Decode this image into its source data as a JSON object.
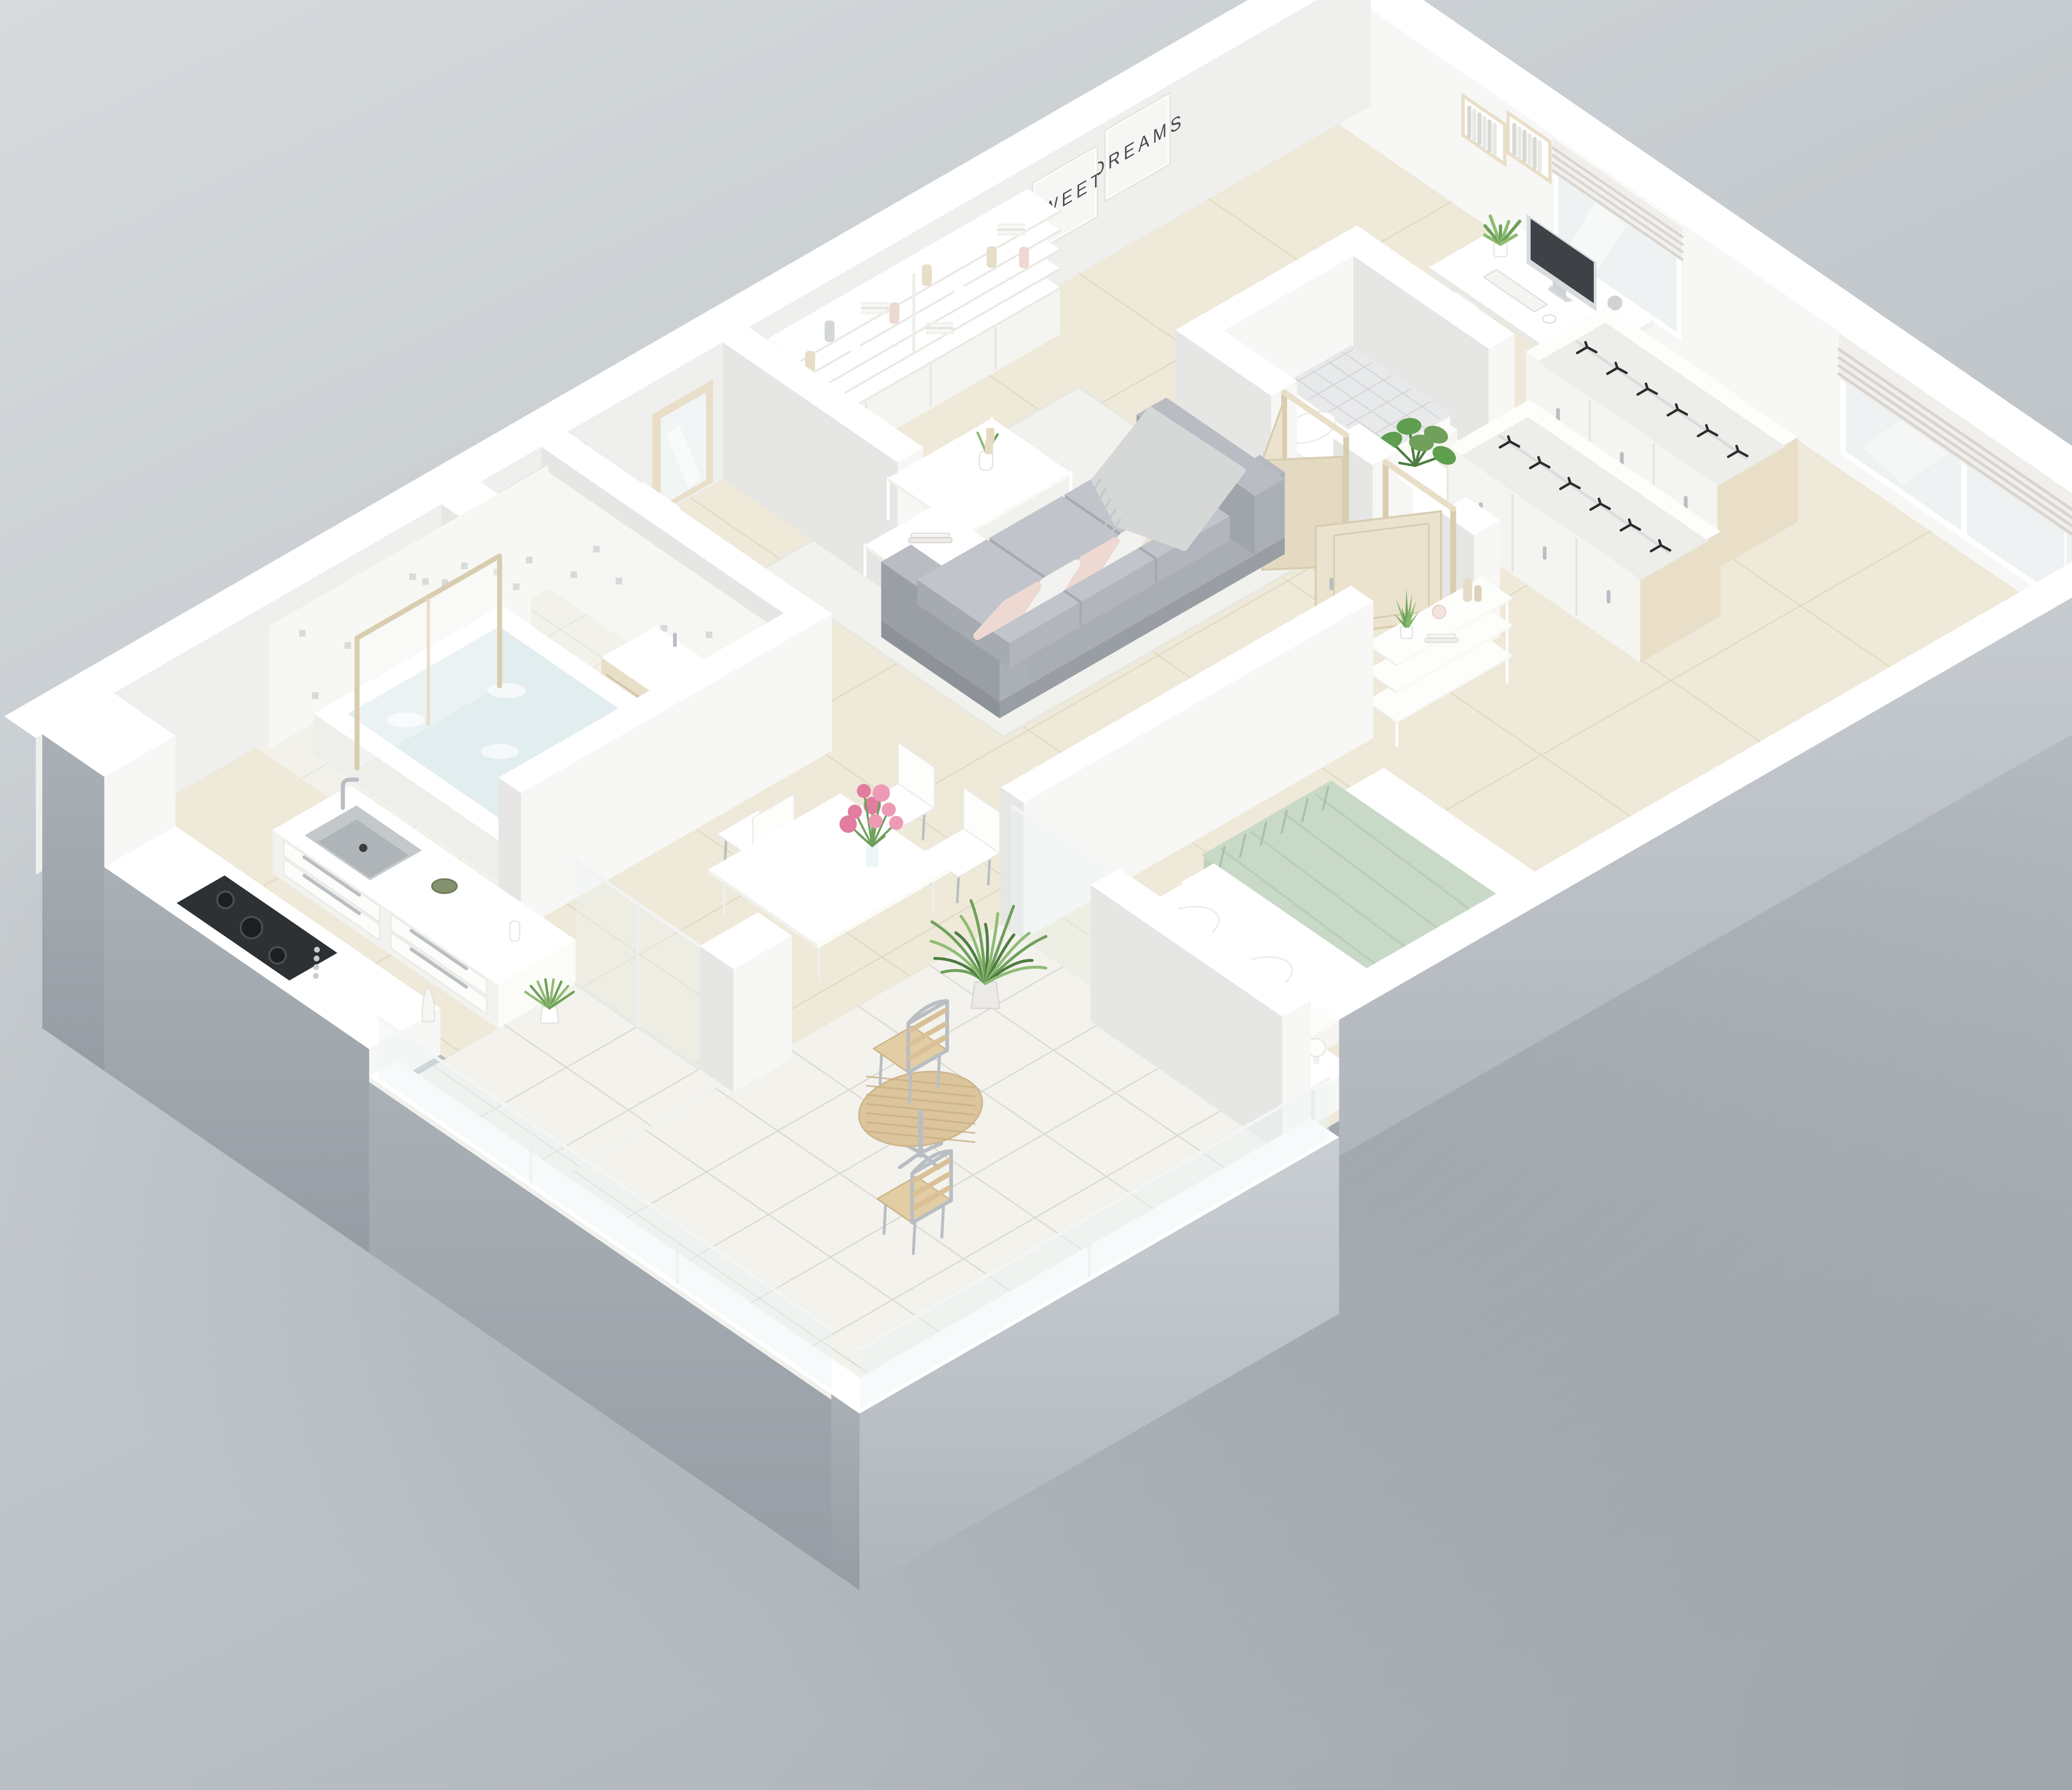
{
  "wall_art": {
    "sweet": "SWEET",
    "dreams": "DREAMS"
  },
  "colors": {
    "background_top": "#d7dbde",
    "background_bottom": "#aeb5ba",
    "corner_shade": "#8e969d",
    "exterior_right": "#c9ced3",
    "exterior_front": "#a9b0b6",
    "wall_top": "#ffffff",
    "wall_light": "#f7f7f5",
    "wall_mid": "#efefed",
    "wall_shadow": "#e6e6e4",
    "floor_cream": "#eee9d8",
    "floor_grout": "#dfd9c4",
    "bath_floor": "#f2f1ea",
    "patio_tile": "#f3f2ed",
    "patio_grout": "#d9d8d1",
    "rug": "#f1f1ee",
    "sofa_base": "#a2a6ad",
    "sofa_dark": "#8d9198",
    "sofa_cushion": "#b2b6bc",
    "sofa_cushion_top": "#c1c4ca",
    "pillow_white": "#f2f2f0",
    "pillow_beige": "#eadfd0",
    "pillow_blush": "#eed8d2",
    "throw_gray": "#d6d7d7",
    "blanket_sage": "#c9d9c7",
    "blanket_sage_dark": "#b5c9b3",
    "bed_white": "#fbfbf9",
    "wood_beige": "#e9dfc9",
    "wood_beige_dark": "#d9cdb0",
    "door_wood": "#ece3cf",
    "chrome": "#b9bec3",
    "screen_dark": "#3e4146",
    "hob_dark": "#2e3134",
    "glass_window": "#eef2f3",
    "glass_balustrade": "rgba(236,243,245,0.45)",
    "blind_white": "#f1efec",
    "blind_fold": "#d8d5d0",
    "plant_green": "#6fa15c",
    "plant_green_dark": "#4e7d42",
    "plant_green_light": "#8fbc74",
    "flower_pink": "#ef9ab5",
    "flower_pink_dark": "#e27da0",
    "water_blue": "#e2edef",
    "poster_text": "#4a4a4a",
    "hanger_black": "#2c2c2c",
    "table_wood": "#dcc59c",
    "table_wood_dark": "#c9b184",
    "mosaic_dot": "#cfd3d4"
  }
}
